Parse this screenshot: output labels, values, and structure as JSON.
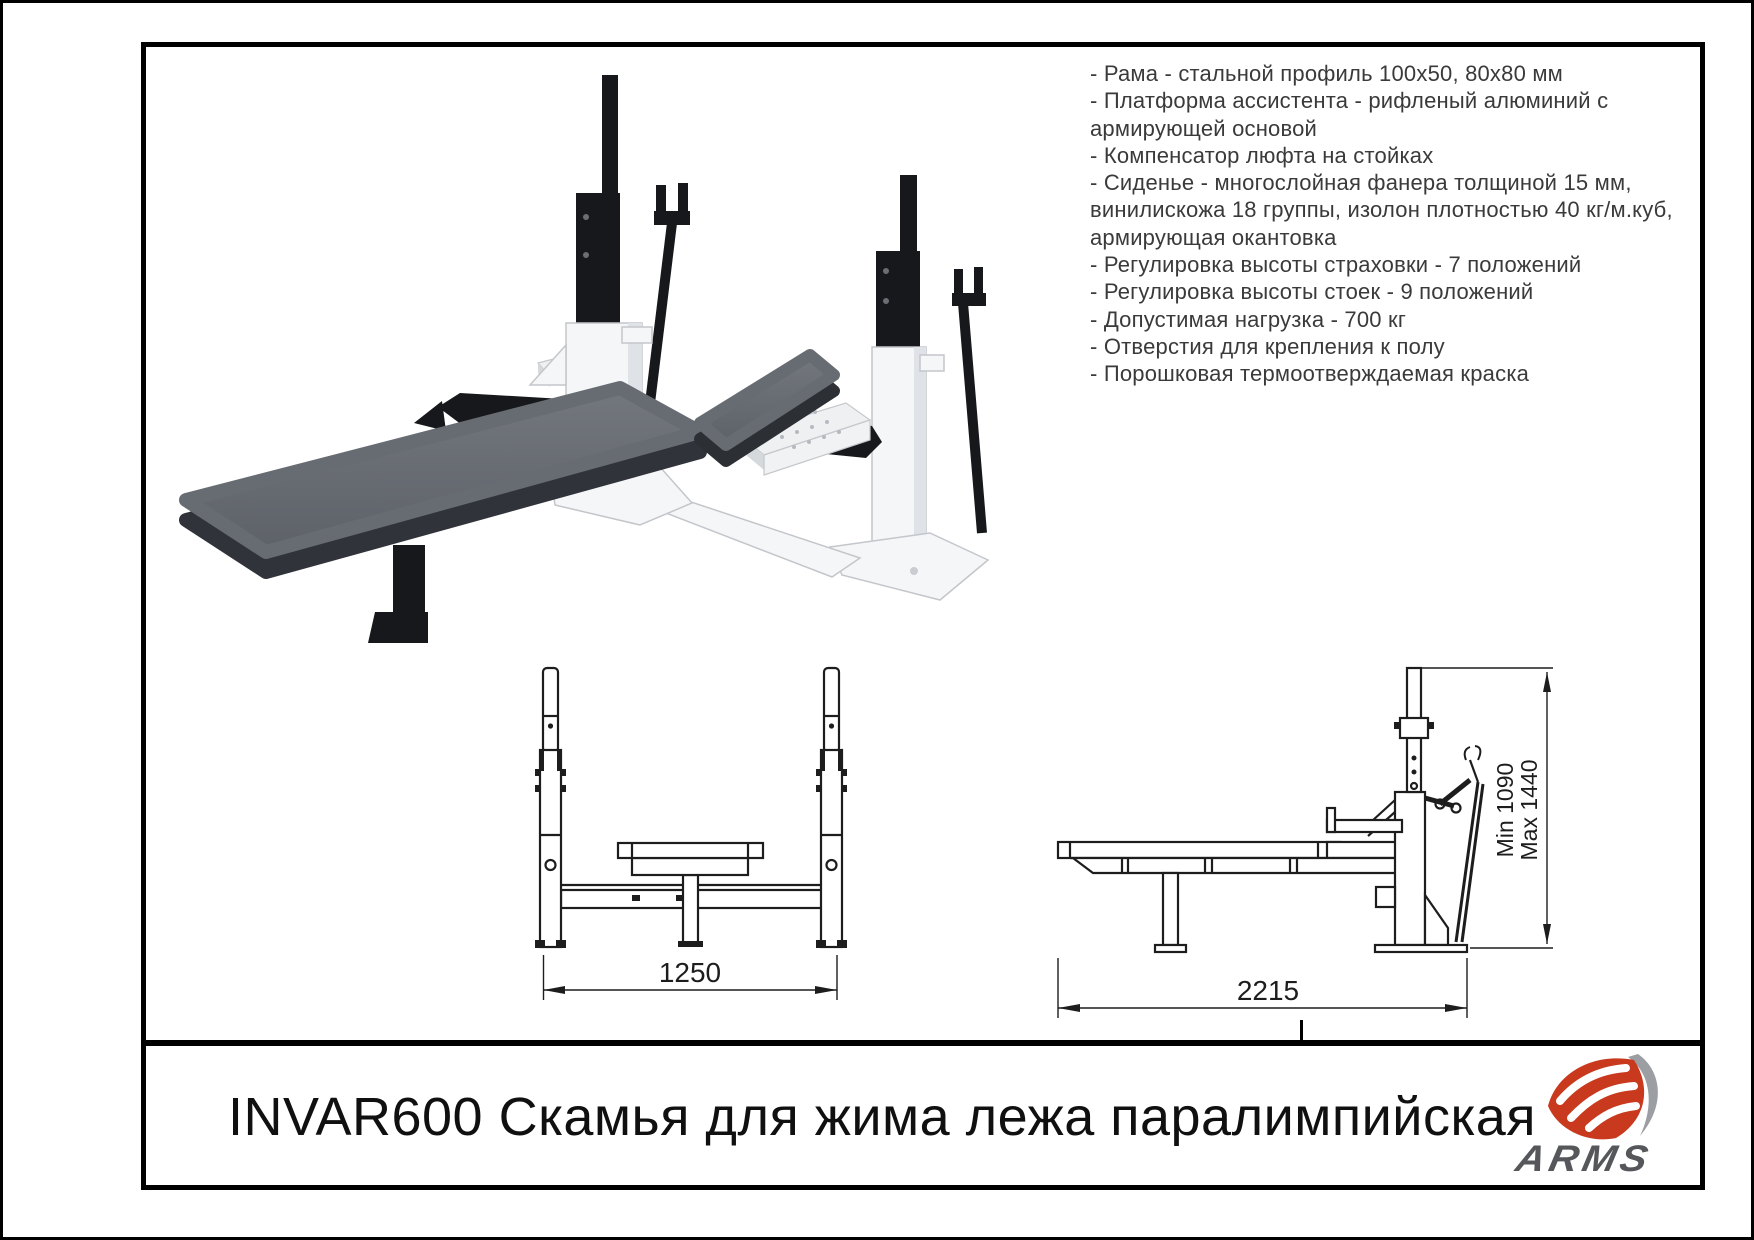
{
  "title_block": {
    "title": "INVAR600 Скамья для жима лежа паралимпийская",
    "brand": "ARMS"
  },
  "specs": {
    "lines": [
      "- Рама - стальной профиль 100х50, 80х80 мм",
      "- Платформа ассистента - рифленый алюминий с",
      "армирующей основой",
      "- Компенсатор люфта на стойках",
      "- Сиденье - многослойная фанера толщиной 15 мм,",
      "винилискожа 18 группы, изолон плотностью 40 кг/м.куб,",
      "армирующая окантовка",
      "- Регулировка высоты страховки - 7 положений",
      "- Регулировка высоты стоек - 9 положений",
      "- Допустимая нагрузка - 700 кг",
      "- Отверстия для крепления к полу",
      "- Порошковая термоотверждаемая краска"
    ]
  },
  "front_view": {
    "width_label": "1250"
  },
  "side_view": {
    "length_label": "2215",
    "height_label_min": "Min 1090",
    "height_label_max": "Max 1440"
  },
  "colors": {
    "accent_red": "#c8391d",
    "logo_gray": "#9b9ea3",
    "brand_text_gray": "#56575a",
    "drawing_line": "#1d1d1d",
    "pad_gray": "#676b72",
    "pad_dark_side": "#30333a",
    "metal_black": "#17181b",
    "steel_white": "#f5f6f8",
    "platform_gray": "#e9ebee"
  }
}
